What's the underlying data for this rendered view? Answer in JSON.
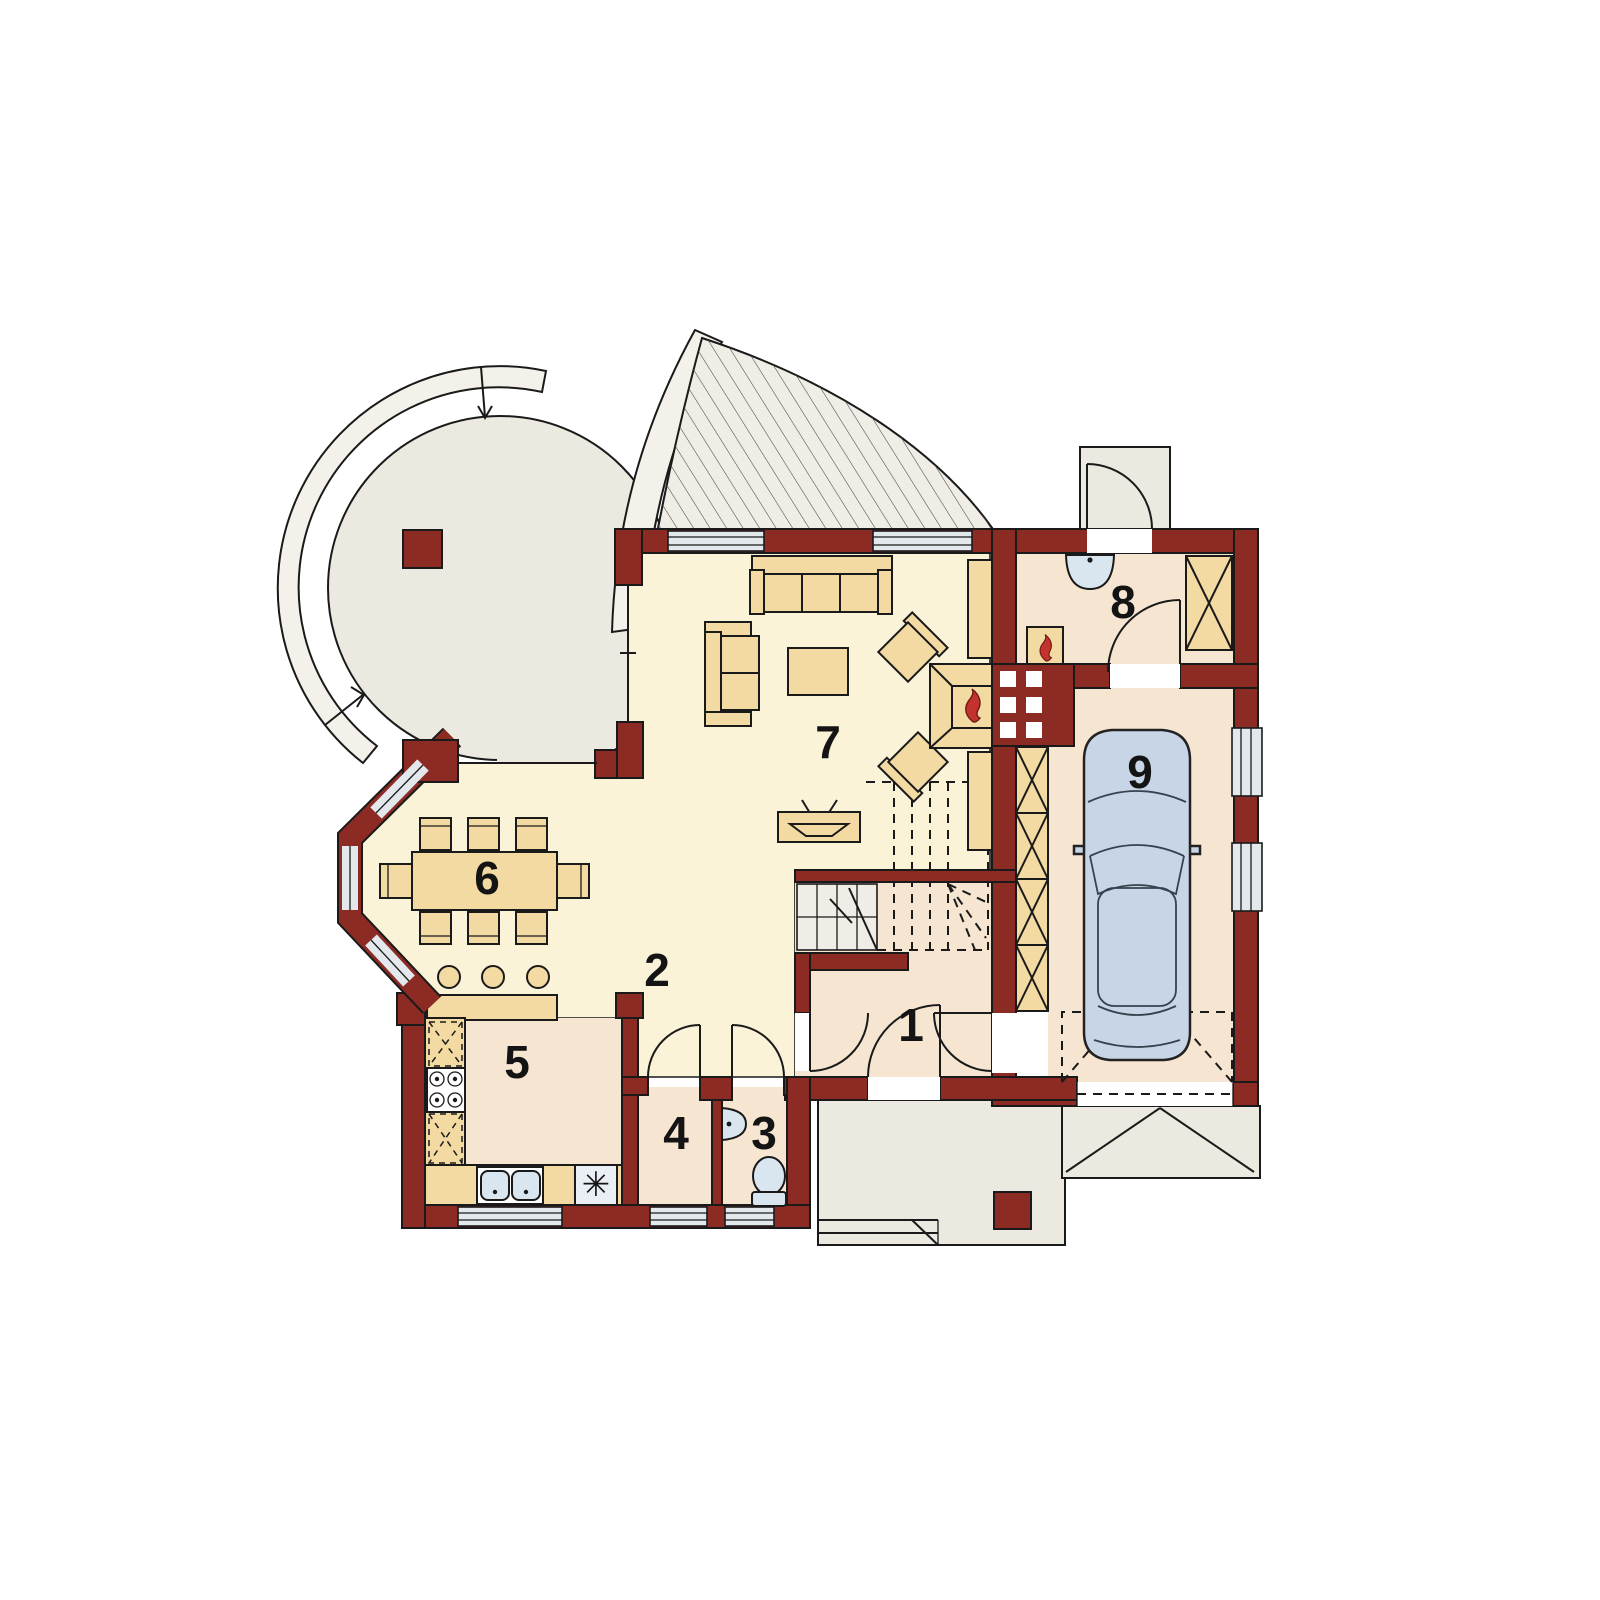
{
  "rooms": [
    {
      "label": "1"
    },
    {
      "label": "2"
    },
    {
      "label": "3"
    },
    {
      "label": "4"
    },
    {
      "label": "5"
    },
    {
      "label": "6"
    },
    {
      "label": "7"
    },
    {
      "label": "8"
    },
    {
      "label": "9"
    }
  ],
  "kitchen": {
    "freezer_symbol": "✳"
  },
  "colors": {
    "wall": "#8c2a24",
    "floor_main": "#faf3d7",
    "floor_secondary": "#f6e5d0",
    "outdoor": "#ece9e0",
    "roof_band": "#f3f1ea",
    "furniture": "#f3d9a2",
    "glazing": "#e2e8ec",
    "fixture": "#d9e6f0",
    "car_body": "#c7d5e6",
    "flame": "#c2332e",
    "line": "#1a1a1a"
  }
}
